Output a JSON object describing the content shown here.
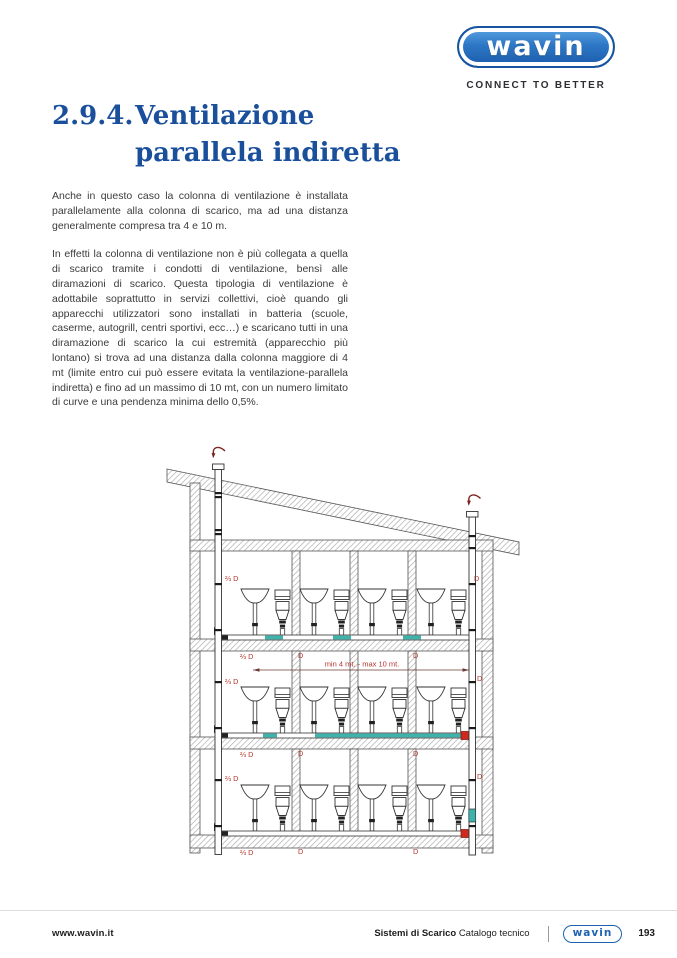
{
  "brand": {
    "logo_text": "wavin",
    "tagline": "CONNECT TO BETTER"
  },
  "title": {
    "number": "2.9.4.",
    "line1": "Ventilazione",
    "line2": "parallela indiretta"
  },
  "body": {
    "paragraph1": "Anche in questo caso la colonna di ventilazione è installata parallelamente alla colonna di scarico, ma ad una distanza generalmente compresa tra 4 e 10 m.",
    "paragraph2": "In effetti la colonna di ventilazione non è più collegata a quella di scarico tramite i condotti di ventilazione, bensì alle diramazioni di scarico. Questa tipologia di ventilazione è adottabile soprattutto in servizi collettivi, cioè quando gli apparecchi utilizzatori sono installati in batteria (scuole, caserme, autogrill, centri sportivi, ecc…) e scaricano tutti in una diramazione di scarico la cui estremità (apparecchio più lontano) si trova ad una distanza dalla colonna maggiore di 4 mt (limite entro cui può essere evitata la ventilazione-parallela indiretta) e fino ad un massimo di 10 mt, con un numero limitato di curve e una pendenza minima dello 0,5%."
  },
  "diagram": {
    "label_vent_column": "⅔ D",
    "label_discharge_column": "D",
    "dimension_note": "min 4 mt. - max 10 mt.",
    "colors": {
      "label_red": "#b5352b",
      "pipe_teal": "#3db3ab",
      "fitting_red": "#cc2a1e",
      "title_blue": "#1a4f9c",
      "logo_blue": "#1e62b0"
    }
  },
  "footer": {
    "website": "www.wavin.it",
    "doc_series": "Sistemi di Scarico",
    "doc_name": "Catalogo tecnico",
    "logo_text": "wavin",
    "page_number": "193"
  }
}
